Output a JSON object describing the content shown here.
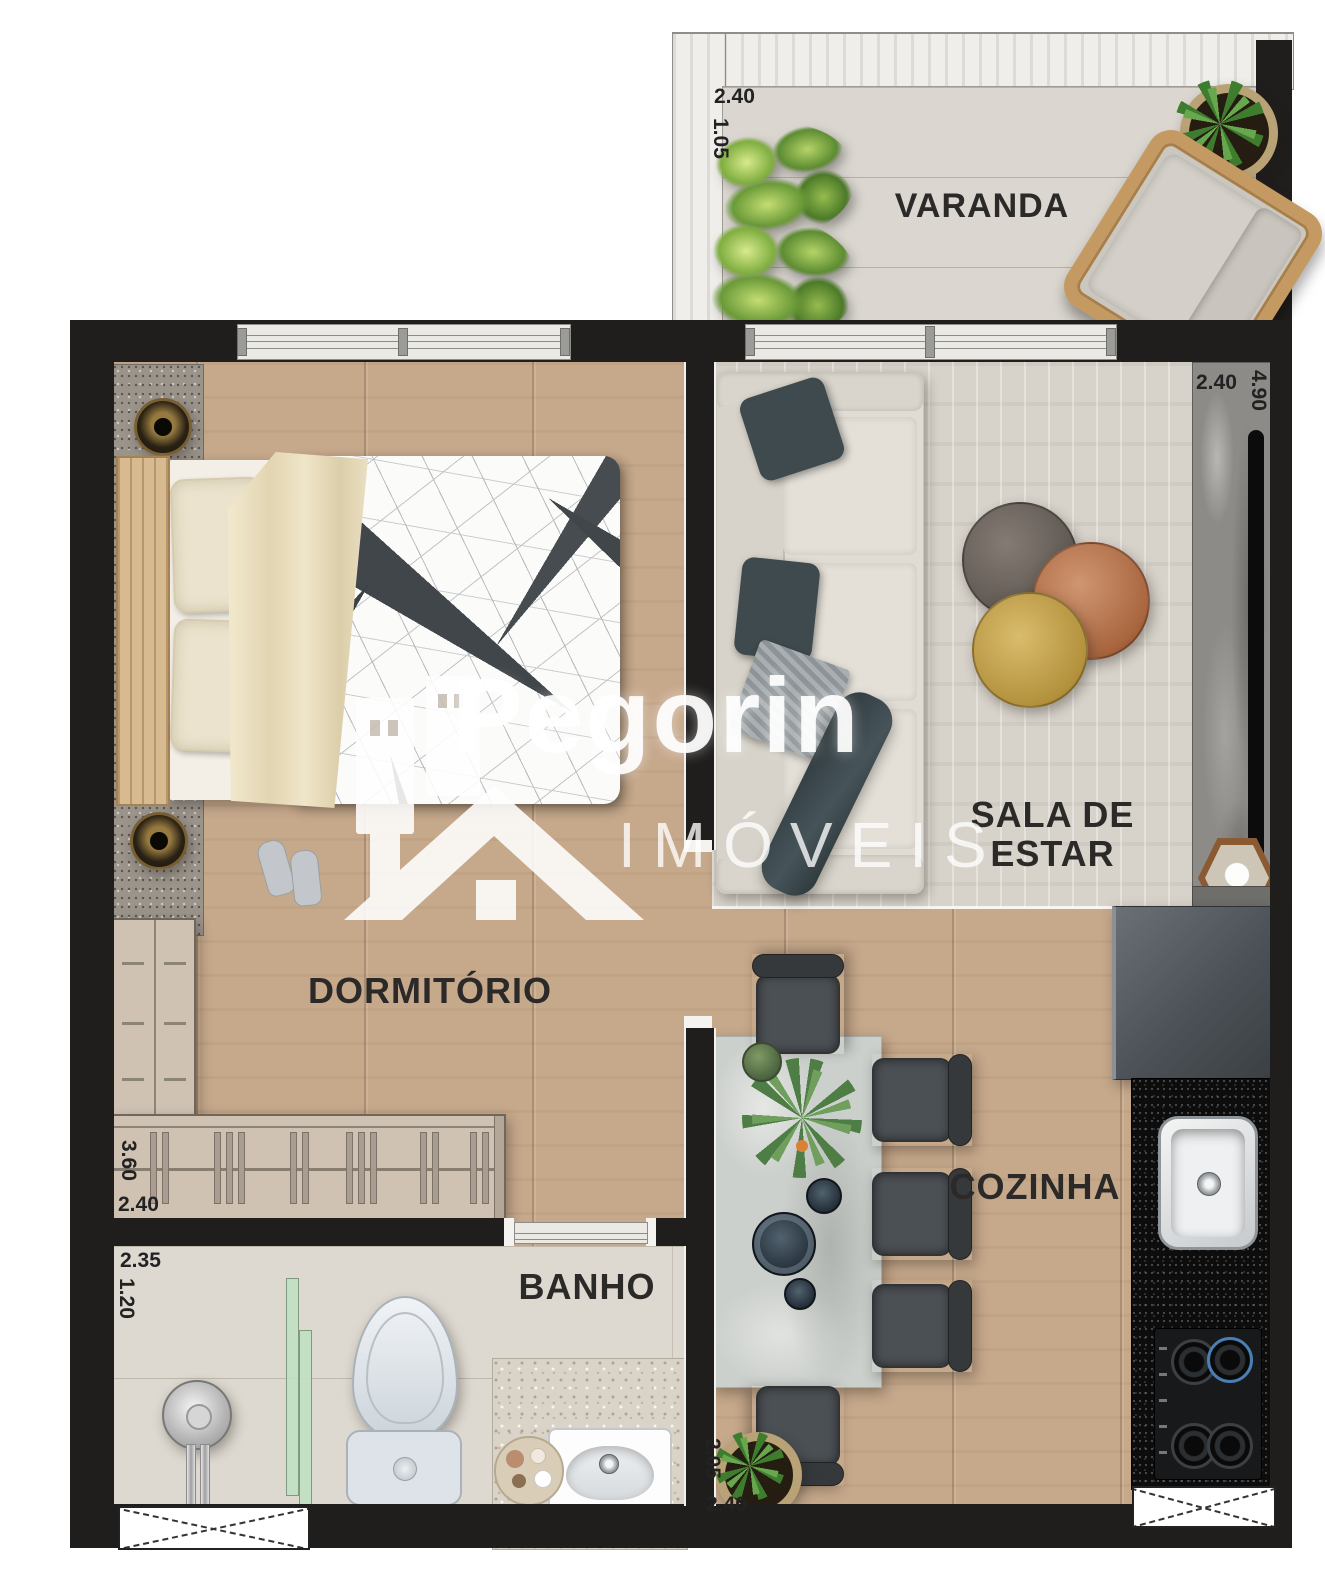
{
  "watermark": {
    "brand": "Pegorin",
    "subtitle": "IMÓVEIS"
  },
  "rooms": {
    "varanda": {
      "label": "VARANDA",
      "dim_width": "2.40",
      "dim_depth": "1.05"
    },
    "sala": {
      "label_line1": "SALA DE",
      "label_line2": "ESTAR",
      "dim_width": "2.40",
      "dim_depth": "4.90"
    },
    "dormitorio": {
      "label": "DORMITÓRIO",
      "dim_depth": "3.60",
      "dim_width": "2.40"
    },
    "cozinha": {
      "label": "COZINHA",
      "dim_depth": "2.05",
      "dim_width": "2.40"
    },
    "banho": {
      "label": "BANHO",
      "dim_width": "2.35",
      "dim_depth": "1.20"
    }
  },
  "colors": {
    "wall": "#201e1c",
    "wood_floor": "#c9aa8d",
    "balcony_floor": "#dbd7d0",
    "bath_floor": "#ded9d0",
    "label_text": "#2b2a28",
    "watermark": "#ffffff",
    "counter": "#0d0d0d",
    "glass_partition": "#bee0c3"
  }
}
